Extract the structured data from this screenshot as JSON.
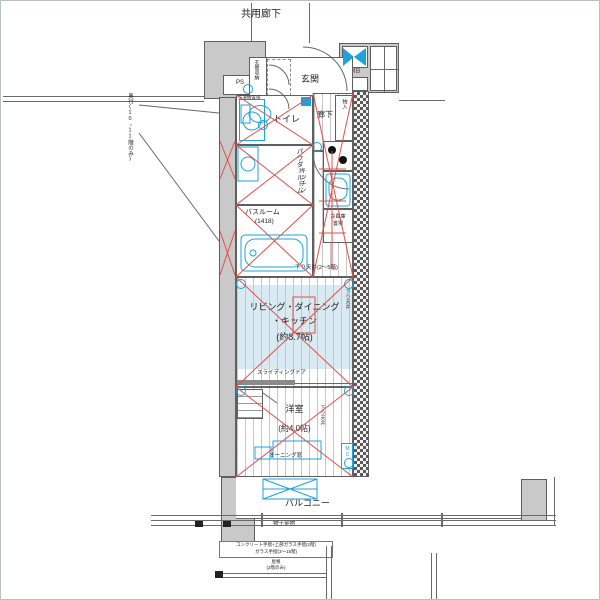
{
  "fp": {
    "common_corridor": "共用廊下",
    "ps": "PS",
    "mb": "MB",
    "entrance": "玄関",
    "entrance_storage": "玄関収納",
    "toilet": "トイレ",
    "hallway": "廊下",
    "cabinet": "物入",
    "washer": "洗濯機置場",
    "powder_room": "パウダールーム",
    "bathroom": "バスルーム",
    "bathroom_size": "(1418)",
    "kitchen": "キッチン",
    "fridge1": "冷蔵庫",
    "fridge2": "置場",
    "ldk1": "リビング・ダイニング",
    "ldk2": "・キッチン",
    "ldk_size": "(約8.7帖)",
    "dc_low": "下り天井(2〜5階)",
    "dc_high": "下り天井(6〜11階)",
    "dc_side": "下り天井",
    "sliding": "スライディングドア",
    "west": "洋室",
    "west_size": "(約4.0帖)",
    "awning": "オーニング窓",
    "mc": "MC",
    "balcony": "バルコニー",
    "laundry": "物干金物",
    "left_note": "奥行(10・11階のみ)",
    "rail1": "コンクリート手摺+上部ガラス手摺(2階)",
    "rail2": "ガラス手摺(3〜15階)",
    "rail3": "屋根",
    "rail4": "(2階のみ)",
    "colors": {
      "wall": "#c9c9c9",
      "accent_cyan": "#1ba3dc",
      "mark_red": "#e0504a",
      "ldk_floor": "#d9eaf3"
    }
  }
}
